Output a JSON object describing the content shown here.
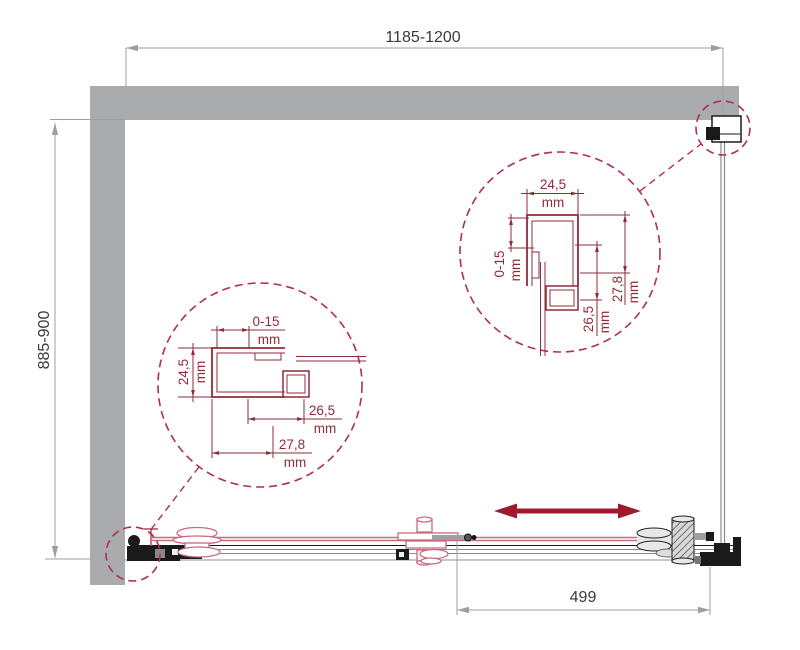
{
  "drawing": {
    "type": "shower-enclosure-installation-diagram",
    "unit": "mm",
    "overall": {
      "width_range": "1185-1200",
      "depth_range": "885-900",
      "door_travel": "499"
    },
    "detail_left_profile": {
      "adjustment_range": "0-15",
      "profile_width": "24,5",
      "inner_depth": "26,5",
      "outer_depth": "27,8"
    },
    "detail_right_profile": {
      "profile_width": "24,5",
      "adjustment_range": "0-15",
      "inner_depth": "26,5",
      "outer_depth": "27,8"
    }
  },
  "colors": {
    "wall": "#a9abad",
    "dim": "#9aa0a4",
    "dimtext": "#3a3a3e",
    "detail": "#8e2c38",
    "callout": "#b12d52",
    "pink": "#c76b7e",
    "arrow": "#9e1b2f",
    "ink": "#1a1a1a",
    "glass": "#8a8d90"
  }
}
